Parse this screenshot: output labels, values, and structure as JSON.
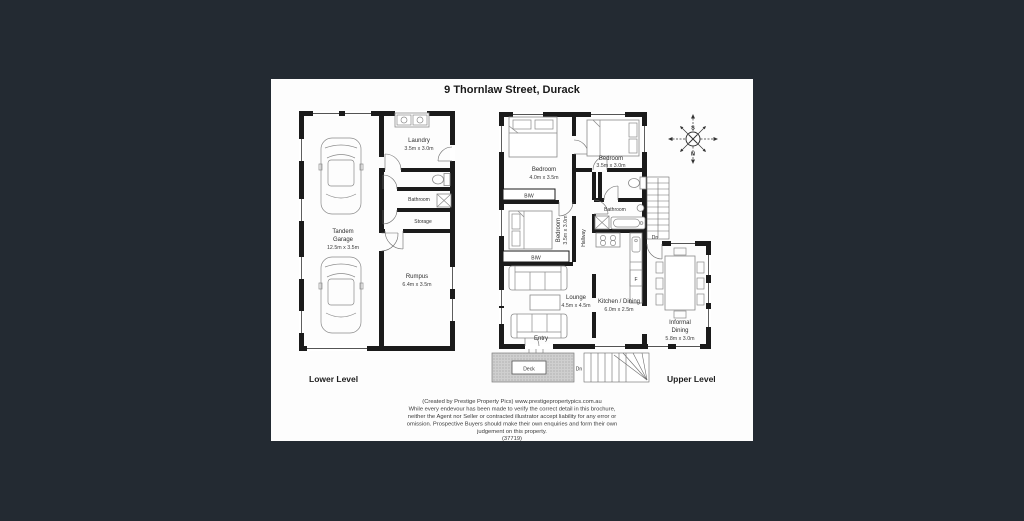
{
  "title": "9 Thornlaw Street, Durack",
  "compass": {
    "top": "S",
    "bottom": "N"
  },
  "lower_level": {
    "label": "Lower Level",
    "laundry_name": "Laundry",
    "laundry_dims": "3.5m x 3.0m",
    "bathroom_name": "Bathroom",
    "storage_name": "Storage",
    "garage_name_line1": "Tandem",
    "garage_name_line2": "Garage",
    "garage_dims": "12.5m x 3.5m",
    "rumpus_name": "Rumpus",
    "rumpus_dims": "6.4m x 3.5m"
  },
  "upper_level": {
    "label": "Upper Level",
    "bedroom1_name": "Bedroom",
    "bedroom1_dims": "4.0m x 3.5m",
    "bedroom2_name": "Bedroom",
    "bedroom2_dims": "3.5m x 3.0m",
    "bedroom3_name": "Bedroom",
    "bedroom3_dims": "3.5m x 3.0m",
    "biw1": "BIW",
    "biw2": "BIW",
    "hallway": "Hallway",
    "bathroom_name": "Bathroom",
    "lounge_name": "Lounge",
    "lounge_dims": "4.5m x 4.5m",
    "kitchen_name": "Kitchen / Dining",
    "kitchen_dims": "6.0m x 2.5m",
    "dining_name_line1": "Informal",
    "dining_name_line2": "Dining",
    "dining_dims": "5.8m x 3.0m",
    "entry": "Entry",
    "deck": "Deck",
    "stairs_dn": "Dn",
    "deck_dn": "Dn",
    "fridge": "F"
  },
  "footer": {
    "line1": "(Created by Prestige Property Pics) www.prestigepropertypics.com.au",
    "line2": "While every endevour has been made to verify the correct detail in this brochure,",
    "line3": "neither the Agent nor Seller or contracted illustrator accept liability for any error or",
    "line4": "omission. Prospective Buyers should make their own enquiries and form their own",
    "line5": "judgement on this property.",
    "line6": "(37719)"
  },
  "colors": {
    "page_background": "#232A32",
    "plan_background": "#FFFFFF",
    "wall": "#1B1B1B"
  }
}
